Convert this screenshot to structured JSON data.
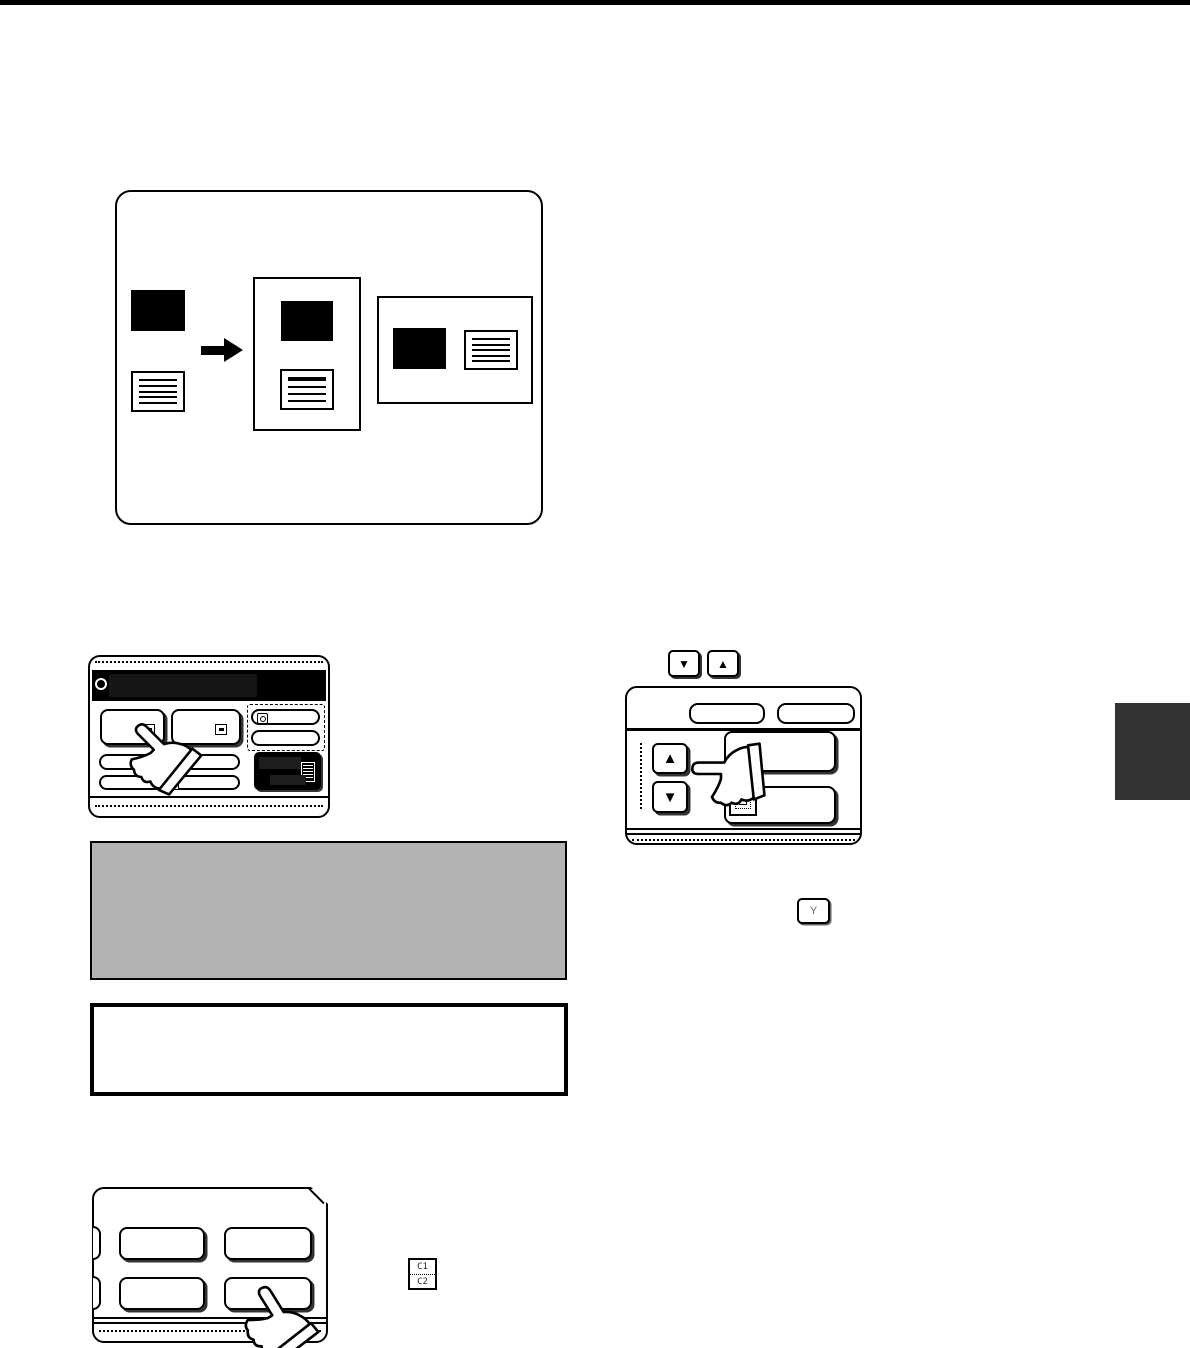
{
  "page": {
    "background": "#ffffff",
    "top_strip_color": "#000000",
    "side_tab_color": "#333333"
  },
  "notes": {
    "gray_box_fill": "#b3b3b3",
    "white_box_border": "#000000"
  },
  "hardware_keys": {
    "scroll_down_key_glyph": "▼",
    "scroll_up_key_glyph": "▲",
    "y_key_label": "Y",
    "c_key_line1": "C1",
    "c_key_line2": "C2"
  },
  "right_panel": {
    "up_button_glyph": "▲",
    "down_button_glyph": "▼"
  }
}
